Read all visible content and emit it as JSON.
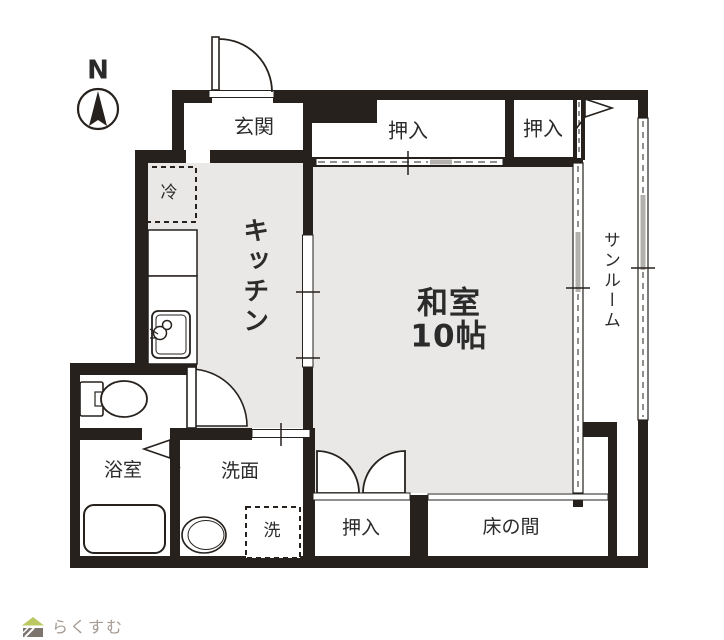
{
  "compass": {
    "label": "N"
  },
  "rooms": {
    "genkan": "玄関",
    "closet_top_left": "押入",
    "closet_top_right": "押入",
    "washitsu_line1": "和室",
    "washitsu_line2": "10帖",
    "kitchen": "キッチン",
    "sunroom": "サンルーム",
    "bathroom": "浴室",
    "washroom": "洗面",
    "closet_bottom": "押入",
    "tokonoma": "床の間"
  },
  "fixtures": {
    "refrigerator": "冷",
    "washing_machine": "洗"
  },
  "logo": {
    "text": "らくすむ"
  },
  "colors": {
    "wall": "#26211d",
    "floor_gray": "#e9e8e6",
    "window_shade": "#b3b1ae",
    "logo_roof_green": "#bcc863",
    "logo_body_brown": "#7c756d",
    "logo_text": "#a59b93"
  }
}
